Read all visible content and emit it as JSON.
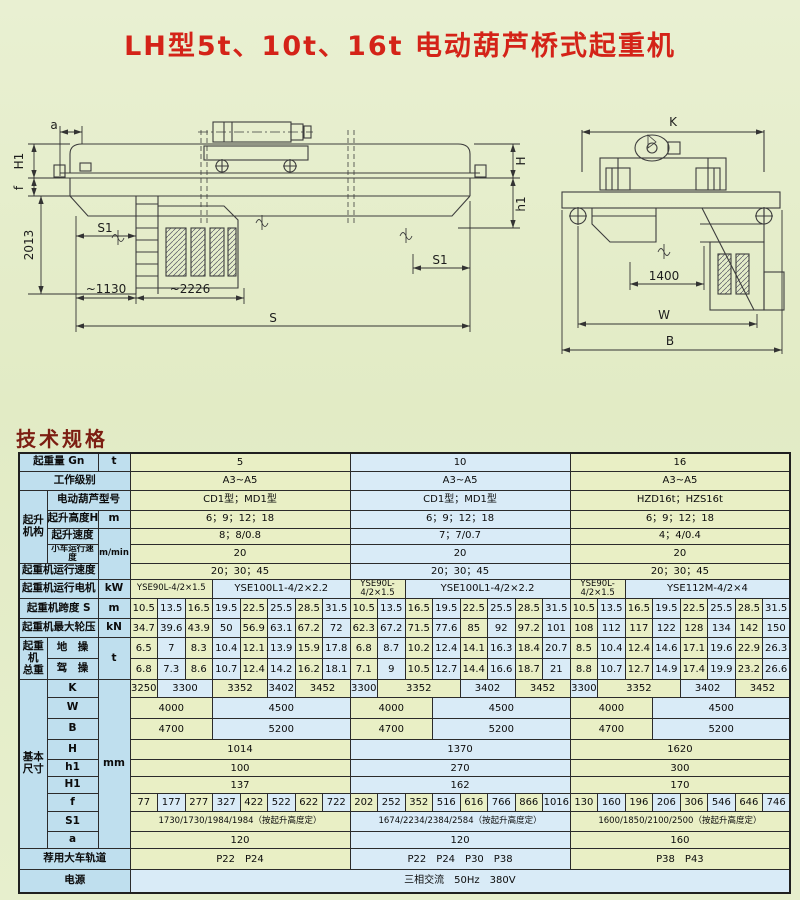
{
  "title": "LH型5t、10t、16t 电动葫芦桥式起重机",
  "heading": "技术规格",
  "colors": {
    "title_red": "#d42318",
    "heading_red": "#7c1e12",
    "label_blue": "#bfdfee",
    "cell_green": "#e9efc5",
    "cell_blue": "#d9ebf7"
  },
  "drawings": {
    "left": {
      "a": "a",
      "H1": "H1",
      "f": "f",
      "d2013": "2013",
      "S1_left": "S1",
      "d1130": "~1130",
      "d2226": "~2226",
      "S": "S",
      "S1_right": "S1",
      "H": "H",
      "h1": "h1"
    },
    "right": {
      "K": "K",
      "d1400": "1400",
      "W": "W",
      "B": "B"
    }
  },
  "table": {
    "col_widths": [
      28,
      51,
      32
    ],
    "data_cols": 24,
    "data_col_width": 27.5,
    "rows": [
      {
        "h": 18,
        "label": "起重量 Gn",
        "lc": 2,
        "unit": {
          "t": "t",
          "rs": 1
        },
        "cells": [
          {
            "t": "5",
            "s": 8
          },
          {
            "t": "10",
            "s": 8
          },
          {
            "t": "16",
            "s": 8
          }
        ]
      },
      {
        "h": 19,
        "label": "工作级别",
        "lc": 3,
        "cells": [
          {
            "t": "A3~A5",
            "s": 8
          },
          {
            "t": "A3~A5",
            "s": 8
          },
          {
            "t": "A3~A5",
            "s": 8
          }
        ]
      },
      {
        "h": 20,
        "group": {
          "t": "起升\n机构",
          "rs": 4
        },
        "label": "电动葫芦型号",
        "lc": 2,
        "cells": [
          {
            "t": "CD1型；MD1型",
            "s": 8
          },
          {
            "t": "CD1型；MD1型",
            "s": 8
          },
          {
            "t": "HZD16t；HZS16t",
            "s": 8
          }
        ]
      },
      {
        "h": 18,
        "label": "起升高度H",
        "lc": 1,
        "unit": {
          "t": "m",
          "rs": 1
        },
        "cells": [
          {
            "t": "6；9；12；18",
            "s": 8
          },
          {
            "t": "6；9；12；18",
            "s": 8
          },
          {
            "t": "6；9；12；18",
            "s": 8
          }
        ]
      },
      {
        "h": 16,
        "label": "起升速度",
        "lc": 1,
        "unit": {
          "t": "m/min",
          "rs": 3,
          "sm": 1
        },
        "cells": [
          {
            "t": "8；8/0.8",
            "s": 8
          },
          {
            "t": "7；7/0.7",
            "s": 8
          },
          {
            "t": "4；4/0.4",
            "s": 8
          }
        ]
      },
      {
        "h": 13,
        "label": "小车运行速度",
        "lc": 1,
        "lsm": 1,
        "cells": [
          {
            "t": "20",
            "s": 8
          },
          {
            "t": "20",
            "s": 8
          },
          {
            "t": "20",
            "s": 8
          }
        ]
      },
      {
        "h": 16,
        "label": "起重机运行速度",
        "lc": 2,
        "cells": [
          {
            "t": "20；30；45",
            "s": 8
          },
          {
            "t": "20；30；45",
            "s": 8
          },
          {
            "t": "20；30；45",
            "s": 8
          }
        ]
      },
      {
        "h": 19,
        "label": "起重机运行电机",
        "lc": 2,
        "unit": {
          "t": "kW",
          "rs": 1
        },
        "cells": [
          {
            "t": "YSE90L-4/2×1.5",
            "s": 3,
            "sm": 1
          },
          {
            "t": "YSE100L1-4/2×2.2",
            "s": 5
          },
          {
            "t": "YSE90L-4/2×1.5",
            "s": 2,
            "sm": 1
          },
          {
            "t": "YSE100L1-4/2×2.2",
            "s": 6
          },
          {
            "t": "YSE90L-4/2×1.5",
            "s": 2,
            "sm": 1
          },
          {
            "t": "YSE112M-4/2×4",
            "s": 6
          }
        ]
      },
      {
        "h": 20,
        "label": "起重机跨度 S",
        "lc": 2,
        "unit": {
          "t": "m",
          "rs": 1
        },
        "cells": [
          "10.5",
          "13.5",
          "16.5",
          "19.5",
          "22.5",
          "25.5",
          "28.5",
          "31.5",
          "10.5",
          "13.5",
          "16.5",
          "19.5",
          "22.5",
          "25.5",
          "28.5",
          "31.5",
          "10.5",
          "13.5",
          "16.5",
          "19.5",
          "22.5",
          "25.5",
          "28.5",
          "31.5"
        ]
      },
      {
        "h": 19,
        "label": "起重机最大轮压",
        "lc": 2,
        "unit": {
          "t": "kN",
          "rs": 1
        },
        "cells": [
          "34.7",
          "39.6",
          "43.9",
          "50",
          "56.9",
          "63.1",
          "67.2",
          "72",
          "62.3",
          "67.2",
          "71.5",
          "77.6",
          "85",
          "92",
          "97.2",
          "101",
          "108",
          "112",
          "117",
          "122",
          "128",
          "134",
          "142",
          "150"
        ]
      },
      {
        "h": 21,
        "group": {
          "t": "起重\n机\n总重",
          "rs": 2
        },
        "label": "地　操",
        "lc": 1,
        "unit": {
          "t": "t",
          "rs": 2
        },
        "cells": [
          "6.5",
          "7",
          "8.3",
          "10.4",
          "12.1",
          "13.9",
          "15.9",
          "17.8",
          "6.8",
          "8.7",
          "10.2",
          "12.4",
          "14.1",
          "16.3",
          "18.4",
          "20.7",
          "8.5",
          "10.4",
          "12.4",
          "14.6",
          "17.1",
          "19.6",
          "22.9",
          "26.3"
        ]
      },
      {
        "h": 21,
        "label": "驾　操",
        "lc": 1,
        "cells": [
          "6.8",
          "7.3",
          "8.6",
          "10.7",
          "12.4",
          "14.2",
          "16.2",
          "18.1",
          "7.1",
          "9",
          "10.5",
          "12.7",
          "14.4",
          "16.6",
          "18.7",
          "21",
          "8.8",
          "10.7",
          "12.7",
          "14.9",
          "17.4",
          "19.9",
          "23.2",
          "26.6"
        ]
      },
      {
        "h": 18,
        "group": {
          "t": "基本\n尺寸",
          "rs": 9
        },
        "label": "K",
        "lc": 1,
        "unit": {
          "t": "mm",
          "rs": 9
        },
        "cells": [
          {
            "t": "3250",
            "s": 1
          },
          {
            "t": "3300",
            "s": 2
          },
          {
            "t": "3352",
            "s": 2
          },
          {
            "t": "3402",
            "s": 1
          },
          {
            "t": "3452",
            "s": 2
          },
          {
            "t": "3300",
            "s": 1
          },
          {
            "t": "3352",
            "s": 3
          },
          {
            "t": "3402",
            "s": 2
          },
          {
            "t": "3452",
            "s": 2
          },
          {
            "t": "3300",
            "s": 1
          },
          {
            "t": "3352",
            "s": 3
          },
          {
            "t": "3402",
            "s": 2
          },
          {
            "t": "3452",
            "s": 2
          }
        ]
      },
      {
        "h": 21,
        "label": "W",
        "lc": 1,
        "cells": [
          {
            "t": "4000",
            "s": 3
          },
          {
            "t": "4500",
            "s": 5
          },
          {
            "t": "4000",
            "s": 3
          },
          {
            "t": "4500",
            "s": 5
          },
          {
            "t": "4000",
            "s": 3
          },
          {
            "t": "4500",
            "s": 5
          }
        ]
      },
      {
        "h": 21,
        "label": "B",
        "lc": 1,
        "cells": [
          {
            "t": "4700",
            "s": 3
          },
          {
            "t": "5200",
            "s": 5
          },
          {
            "t": "4700",
            "s": 3
          },
          {
            "t": "5200",
            "s": 5
          },
          {
            "t": "4700",
            "s": 3
          },
          {
            "t": "5200",
            "s": 5
          }
        ]
      },
      {
        "h": 20,
        "label": "H",
        "lc": 1,
        "cells": [
          {
            "t": "1014",
            "s": 8
          },
          {
            "t": "1370",
            "s": 8
          },
          {
            "t": "1620",
            "s": 8
          }
        ]
      },
      {
        "h": 17,
        "label": "h1",
        "lc": 1,
        "cells": [
          {
            "t": "100",
            "s": 8
          },
          {
            "t": "270",
            "s": 8
          },
          {
            "t": "300",
            "s": 8
          }
        ]
      },
      {
        "h": 17,
        "label": "H1",
        "lc": 1,
        "cells": [
          {
            "t": "137",
            "s": 8
          },
          {
            "t": "162",
            "s": 8
          },
          {
            "t": "170",
            "s": 8
          }
        ]
      },
      {
        "h": 18,
        "label": "f",
        "lc": 1,
        "cells": [
          "77",
          "177",
          "277",
          "327",
          "422",
          "522",
          "622",
          "722",
          "202",
          "252",
          "352",
          "516",
          "616",
          "766",
          "866",
          "1016",
          "130",
          "160",
          "196",
          "206",
          "306",
          "546",
          "646",
          "746"
        ]
      },
      {
        "h": 20,
        "label": "S1",
        "lc": 1,
        "cells": [
          {
            "t": "1730/1730/1984/1984（按起升高度定）",
            "s": 8,
            "sm": 1
          },
          {
            "t": "1674/2234/2384/2584（按起升高度定）",
            "s": 8,
            "sm": 1
          },
          {
            "t": "1600/1850/2100/2500（按起升高度定）",
            "s": 8,
            "sm": 1
          }
        ]
      },
      {
        "h": 17,
        "label": "a",
        "lc": 1,
        "cells": [
          {
            "t": "120",
            "s": 8
          },
          {
            "t": "120",
            "s": 8
          },
          {
            "t": "160",
            "s": 8
          }
        ]
      },
      {
        "h": 21,
        "label": "荐用大车轨道",
        "lc": 3,
        "cells": [
          {
            "t": "P22　P24",
            "s": 8
          },
          {
            "t": "P22　P24　P30　P38",
            "s": 8
          },
          {
            "t": "P38　P43",
            "s": 8
          }
        ]
      },
      {
        "h": 23,
        "label": "电源",
        "lc": 3,
        "cells": [
          {
            "t": "三相交流　50Hz　380V",
            "s": 24,
            "bg": "cb"
          }
        ]
      }
    ]
  }
}
